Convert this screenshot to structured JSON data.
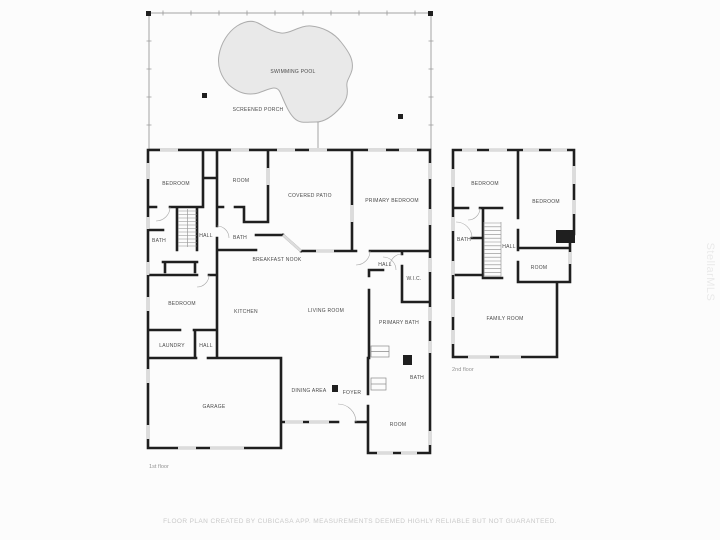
{
  "porch": {
    "labels": [
      {
        "label": "SWIMMING POOL",
        "x": 293,
        "y": 73
      },
      {
        "label": "SCREENED PORCH",
        "x": 258,
        "y": 111
      }
    ]
  },
  "floors": {
    "first": {
      "name": "1st floor",
      "rooms": [
        {
          "label": "BEDROOM",
          "x": 176,
          "y": 185
        },
        {
          "label": "ROOM",
          "x": 241,
          "y": 182
        },
        {
          "label": "COVERED PATIO",
          "x": 310,
          "y": 197
        },
        {
          "label": "PRIMARY BEDROOM",
          "x": 392,
          "y": 202
        },
        {
          "label": "BATH",
          "x": 159,
          "y": 242
        },
        {
          "label": "HALL",
          "x": 206,
          "y": 237
        },
        {
          "label": "BATH",
          "x": 240,
          "y": 239
        },
        {
          "label": "BREAKFAST NOOK",
          "x": 277,
          "y": 261
        },
        {
          "label": "HALL",
          "x": 385,
          "y": 266
        },
        {
          "label": "W.I.C.",
          "x": 414,
          "y": 280
        },
        {
          "label": "BEDROOM",
          "x": 182,
          "y": 305
        },
        {
          "label": "KITCHEN",
          "x": 246,
          "y": 313
        },
        {
          "label": "LIVING ROOM",
          "x": 326,
          "y": 312
        },
        {
          "label": "PRIMARY BATH",
          "x": 399,
          "y": 324
        },
        {
          "label": "LAUNDRY",
          "x": 172,
          "y": 347
        },
        {
          "label": "HALL",
          "x": 206,
          "y": 347
        },
        {
          "label": "GARAGE",
          "x": 214,
          "y": 408
        },
        {
          "label": "DINING AREA",
          "x": 309,
          "y": 392
        },
        {
          "label": "FOYER",
          "x": 352,
          "y": 394
        },
        {
          "label": "BATH",
          "x": 417,
          "y": 379
        },
        {
          "label": "ROOM",
          "x": 398,
          "y": 426
        }
      ]
    },
    "second": {
      "name": "2nd floor",
      "rooms": [
        {
          "label": "BEDROOM",
          "x": 485,
          "y": 185
        },
        {
          "label": "BEDROOM",
          "x": 546,
          "y": 203
        },
        {
          "label": "BATH",
          "x": 464,
          "y": 241
        },
        {
          "label": "HALL",
          "x": 509,
          "y": 248
        },
        {
          "label": "ROOM",
          "x": 539,
          "y": 269
        },
        {
          "label": "FAMILY ROOM",
          "x": 505,
          "y": 320
        }
      ]
    }
  },
  "footer": {
    "disclaimer": "FLOOR PLAN CREATED BY CUBICASA APP. MEASUREMENTS DEEMED HIGHLY RELIABLE BUT NOT GUARANTEED."
  },
  "watermark": {
    "text": "StellarMLS"
  },
  "colors": {
    "wall": "#1f1f1f",
    "window": "#dcdcdc",
    "pool_fill": "#e9e9e9",
    "pool_edge": "#adadad",
    "label": "#4a4a4a",
    "footer": "#c9c9c9"
  }
}
